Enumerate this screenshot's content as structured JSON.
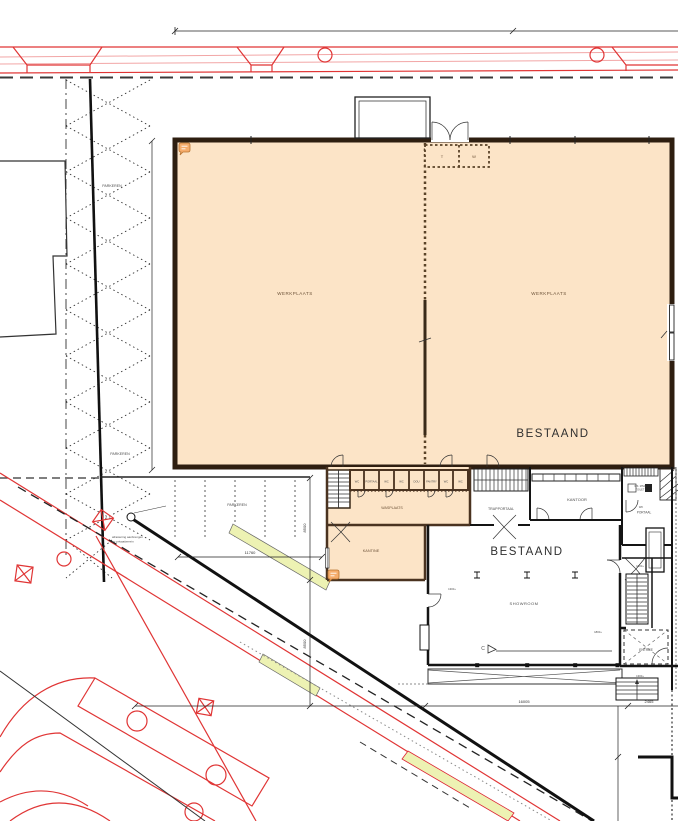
{
  "labels": {
    "werkplaats_left": "WERKPLAATS",
    "werkplaats_right": "WERKPLAATS",
    "bestaand_hall": "BESTAAND",
    "bestaand_lower": "BESTAAND",
    "parkeren_1": "PARKEREN",
    "parkeren_2": "PARKEREN",
    "parkeren_3": "PARKEREN",
    "wasplaats": "WASPLAATS",
    "kantine": "KANTINE",
    "trapportaal": "TRAPPORTAAL",
    "kantoor": "KANTOOR",
    "showroom": "SHOWROOM",
    "entree": "ENTREE",
    "wk": "WK",
    "portaal": "PORTAAL",
    "miva1": "WK. MIVA",
    "miva2": "TOILET",
    "room_t": "T",
    "room_w": "W"
  },
  "small_rooms": [
    "WC",
    "PORTAAL",
    "WC",
    "WC",
    "DOU",
    "PANTRY",
    "WC",
    "WC"
  ],
  "dims": {
    "w_hall": "11760",
    "w_show": "16005",
    "w_entr": "2465",
    "h_a": "8500",
    "h_b": "8500"
  },
  "levels": {
    "a": "1300+",
    "b": "1800+",
    "c": "1800+",
    "d": "1300+"
  },
  "annotations": {
    "section": "C",
    "note1": "afrastering aanbrengen",
    "note2": "op privaatterrein"
  },
  "colors": {
    "plan_fill": "#fce4c7",
    "wall_dark": "#2e1e10",
    "wall_brown": "#4a3320",
    "road_red": "#e03535",
    "verge_green": "#edf2b3",
    "note_orange": "#f6ad6d"
  }
}
